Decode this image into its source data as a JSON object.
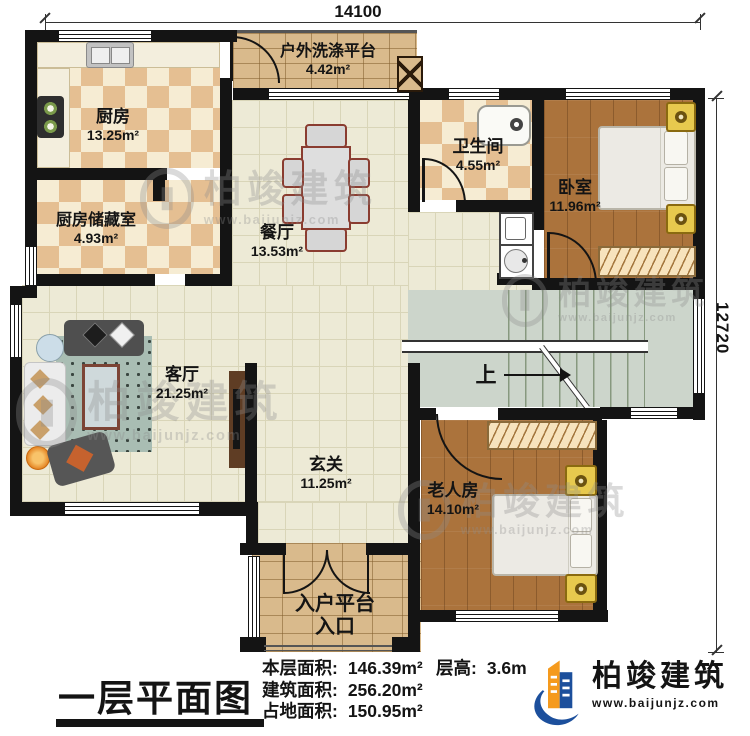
{
  "plan": {
    "title": "一层平面图",
    "dim_top": "14100",
    "dim_right": "12720",
    "up_label": "上",
    "stats": [
      {
        "label": "本层面积:",
        "value": "146.39m²"
      },
      {
        "label": "建筑面积:",
        "value": "256.20m²"
      },
      {
        "label": "占地面积:",
        "value": "150.95m²"
      }
    ],
    "floor_height": {
      "label": "层高:",
      "value": "3.6m"
    }
  },
  "rooms": [
    {
      "name": "厨房",
      "area": "13.25m²"
    },
    {
      "name": "厨房储藏室",
      "area": "4.93m²"
    },
    {
      "name": "户外洗涤平台",
      "area": "4.42m²"
    },
    {
      "name": "餐厅",
      "area": "13.53m²"
    },
    {
      "name": "卫生间",
      "area": "4.55m²"
    },
    {
      "name": "卧室",
      "area": "11.96m²"
    },
    {
      "name": "客厅",
      "area": "21.25m²"
    },
    {
      "name": "玄关",
      "area": "11.25m²"
    },
    {
      "name": "老人房",
      "area": "14.10m²"
    },
    {
      "name": "入户平台",
      "sub": "入口"
    }
  ],
  "brand": {
    "name": "柏竣建筑",
    "url": "www.baijunjz.com"
  },
  "watermark": {
    "text": "柏竣建筑",
    "url": "www.baijunjz.com"
  },
  "colors": {
    "wall": "#141414",
    "tile_floor": "#edead6",
    "checker_tan": "#e5bf92",
    "wood_floor": "#ab733c",
    "brick": "#d9ba8c",
    "stairs": "#ccd5cb",
    "brand_blue": "#1c4f9c",
    "brand_orange": "#f59a1d"
  }
}
